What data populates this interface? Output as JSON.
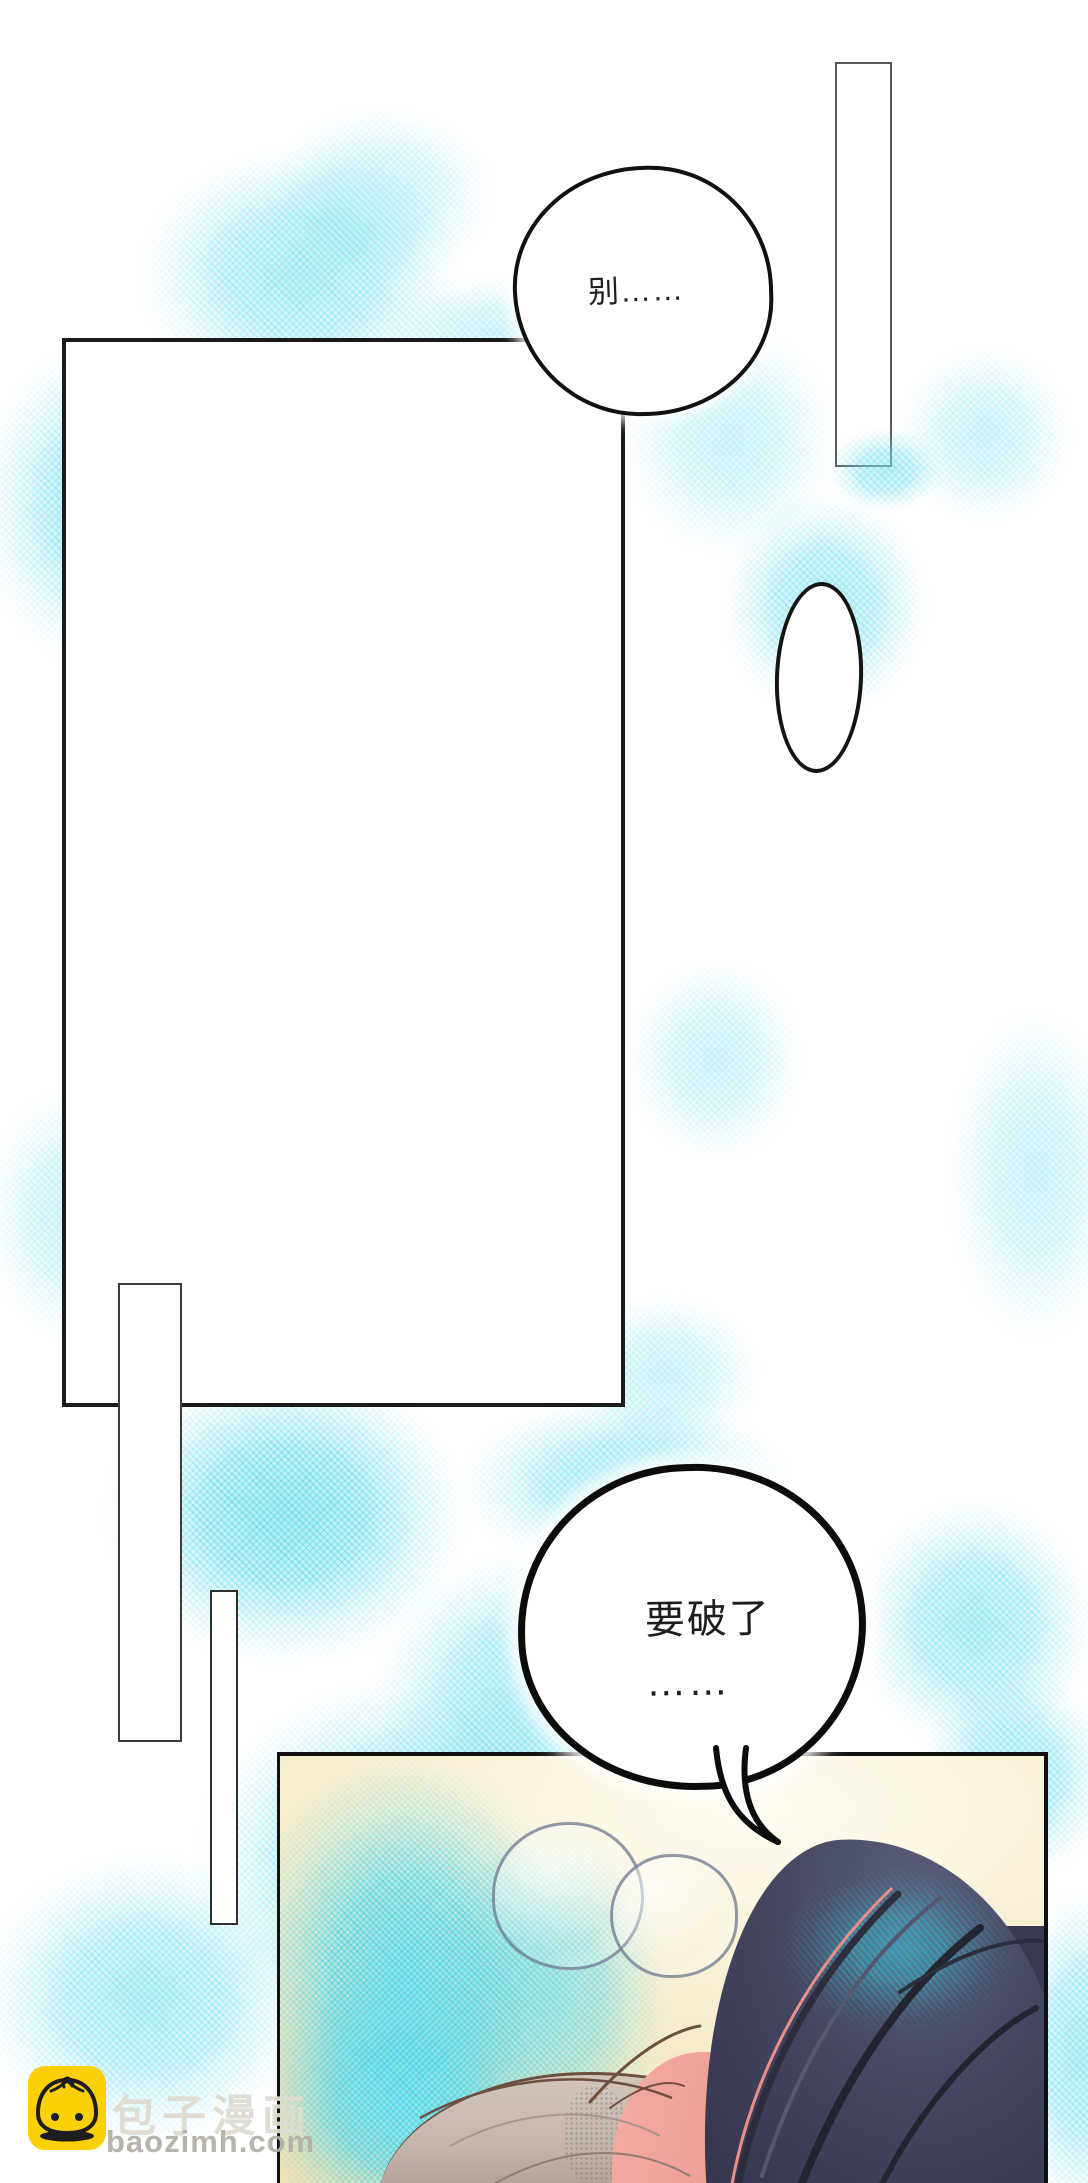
{
  "speech_bubbles": {
    "bubble_top": {
      "text": "别……"
    },
    "bubble_bottom": {
      "line1": "要破了",
      "line2": "……"
    }
  },
  "watermark": {
    "brand": "包子漫画",
    "site": "baozimh.com",
    "icon": "bun-mascot-icon",
    "icon_bg_color": "#fcd006"
  },
  "colors": {
    "background": "#ffffff",
    "watercolor_cyan": "#8ee6f0",
    "panel_border_black": "#1b1b1b",
    "thin_frame_gray": "#5a5a5a",
    "bottom_panel_cream": "#f6edca",
    "dark_hair": "#3e4056",
    "hair_teal_sheen": "#46becd",
    "blonde_hair": "#c9bcb2",
    "skin_pink": "#efa19a",
    "bubble_outline": "#0c0c0c"
  }
}
